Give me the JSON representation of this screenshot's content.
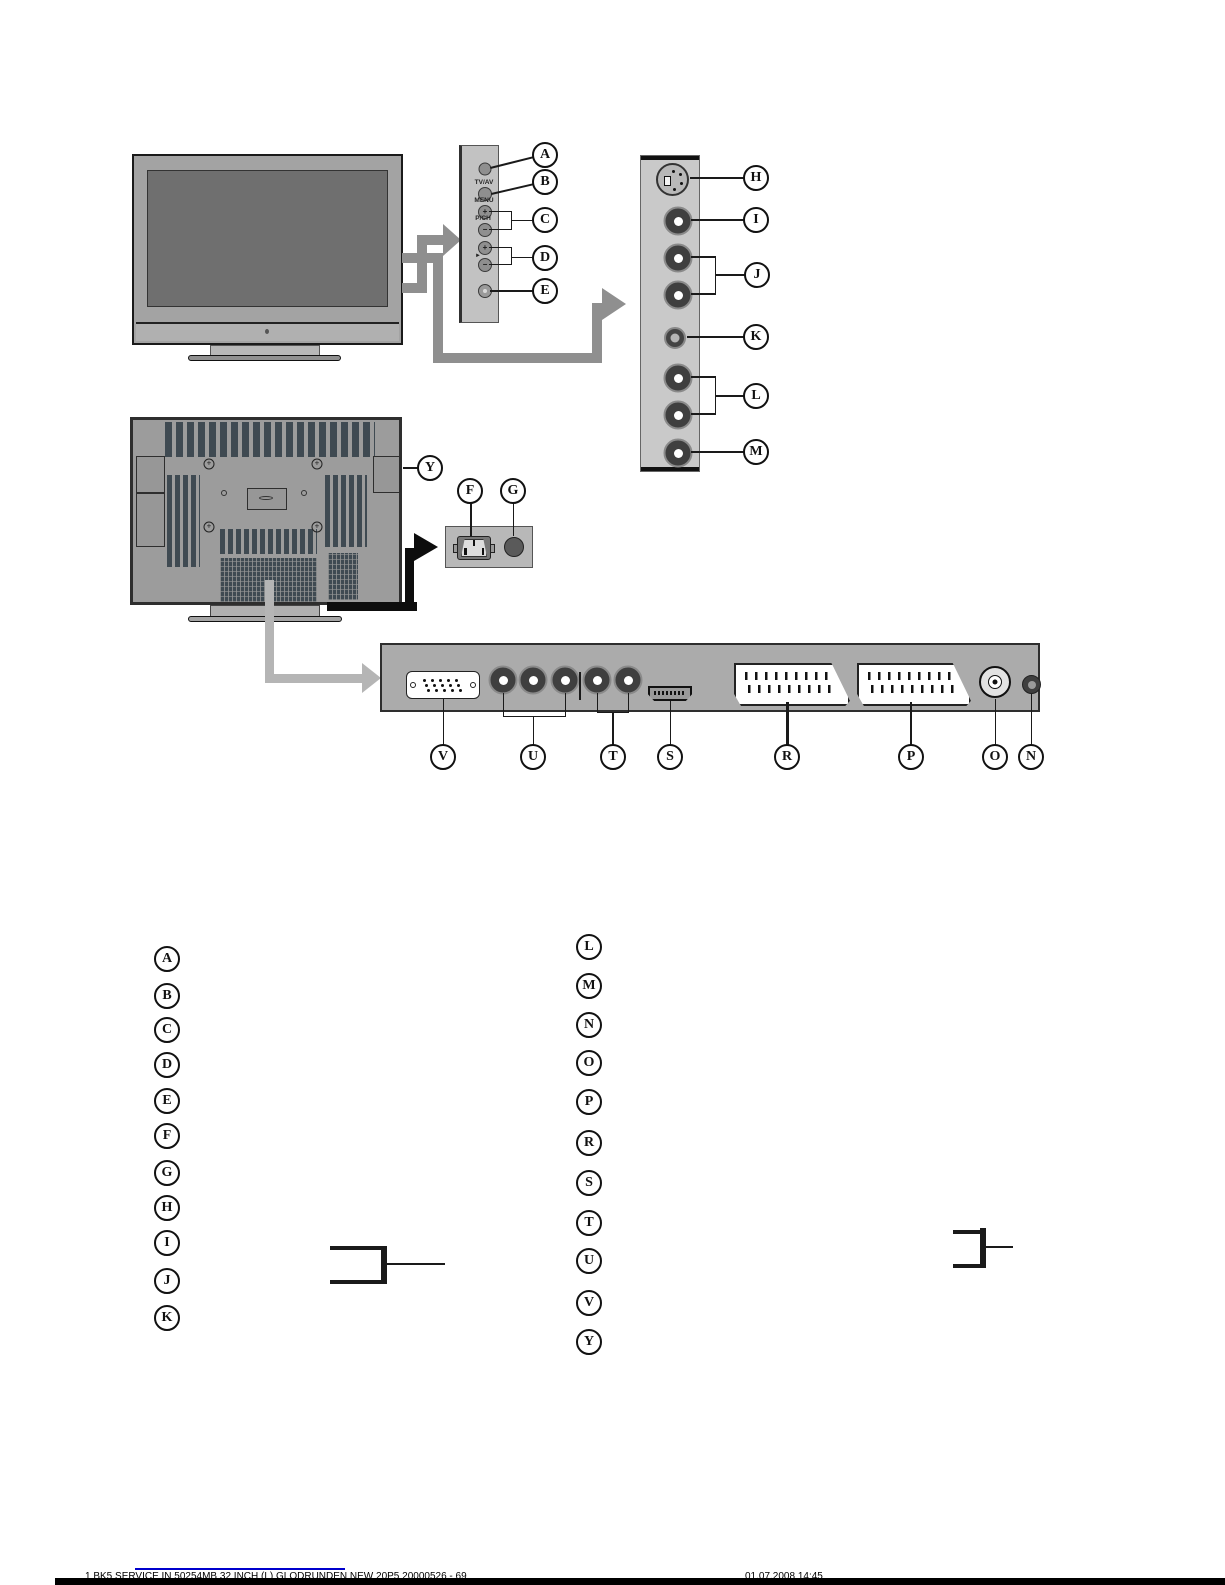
{
  "page": {
    "type": "tv-manual-connection-diagram",
    "background": "#ffffff"
  },
  "colors": {
    "panel_gray": "#c6c6c6",
    "strip_gray": "#ababab",
    "tv_gray": "#9c9c9c",
    "vent_dark": "#3f4a52",
    "arrow_gray": "#8f8f8f",
    "arrow_light": "#b5b5b5",
    "arrow_black": "#0d0d0d",
    "link_blue": "#0000cc"
  },
  "icons": {
    "front_view": "tv-front-view",
    "back_view": "tv-back-view",
    "svideo": "svideo-jack",
    "rca": "rca-jack",
    "headphone": "headphone-jack",
    "vga": "vga-connector",
    "hdmi": "hdmi-connector",
    "scart": "scart-connector",
    "rf": "rf-antenna-connector",
    "power_inlet": "ac-power-inlet",
    "power_switch": "power-switch"
  },
  "side_panel_text": {
    "tv_av": "TV/AV",
    "menu": "MENU",
    "pch": "P/CH",
    "pointer": "►",
    "plus": "+",
    "minus": "−"
  },
  "callouts": {
    "side_control": [
      "A",
      "B",
      "C",
      "D",
      "E"
    ],
    "power": [
      "F",
      "G"
    ],
    "side_av": [
      "H",
      "I",
      "J",
      "K",
      "L",
      "M"
    ],
    "back": "Y",
    "bottom": [
      "V",
      "U",
      "T",
      "S",
      "R",
      "P",
      "O",
      "N"
    ]
  },
  "legend": {
    "left": [
      "A",
      "B",
      "C",
      "D",
      "E",
      "F",
      "G",
      "H",
      "I",
      "J",
      "K"
    ],
    "right": [
      "L",
      "M",
      "N",
      "O",
      "P",
      "R",
      "S",
      "T",
      "U",
      "V",
      "Y"
    ]
  },
  "footer": {
    "clipped_left_text": "1 BK5 SERVICE IN 50254MB 32 INCH (L) GLODRUNDEN NEW 20P5 20000526 - 69",
    "clipped_right_text": "01.07.2008 14:45"
  }
}
